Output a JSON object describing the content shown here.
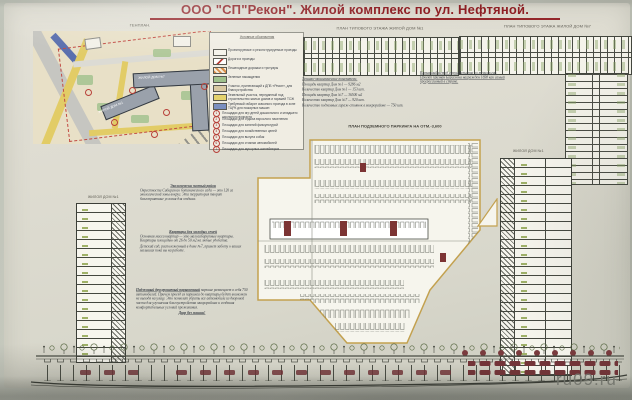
{
  "title": "ООО \"СП\"Рекон\".  Жилой комплекс по ул. Нефтяной.",
  "watermark": "ru09.ru",
  "sections": {
    "genplan": "ГЕНПЛАН.",
    "plan1": "ПЛАН ТИПОВОГО ЭТАЖА ЖИЛОЙ ДОМ №1",
    "plan7": "ПЛАН ТИПОВОГО ЭТАЖА ЖИЛОЙ ДОМ №7",
    "parking": "ПЛАН ПОДЗЕМНОГО ПАРКИНГА НА ОТМ.-3,600",
    "tower_left": "ЖИЛОЙ ДОМ №1",
    "tower_right": "ЖИЛОЙ ДОМ №1"
  },
  "genplan": {
    "building1": "ЖИЛОЙ ДОМ №1",
    "building7": "ЖИЛОЙ ДОМ №7"
  },
  "legend": {
    "title": "Условные обозначения",
    "swatches": [
      {
        "color": "#f5f3ea",
        "label": "Проектируемые и реконструируемые проезды"
      },
      {
        "color": "#ffffff",
        "label": "Дороги и проезды"
      },
      {
        "color": "#d98f4a",
        "label": "Пешеходные дорожки и тротуары"
      },
      {
        "color": "#9fc18c",
        "label": "Зеленые насаждения"
      },
      {
        "color": "#d9c9a2",
        "label": "Участок, прилегающий к ДПБ «Рекон», для благоустройства"
      },
      {
        "color": "#e4d26b",
        "label": "Земельный участок, переданный под строительство жилых домов и гаражей ТСЖ"
      },
      {
        "color": "#7a8fc0",
        "label": "Требуемый габарит сквозного проезда в зоне ТЦРК для пожарных машин"
      }
    ],
    "numbered": [
      {
        "n": "1",
        "label": "Площадки для игр детей дошкольного и младшего школьного возраста"
      },
      {
        "n": "2",
        "label": "Площадки для отдыха взрослого населения"
      },
      {
        "n": "3",
        "label": "Площадки для занятий физкультурой"
      },
      {
        "n": "4",
        "label": "Площадки для хозяйственных целей"
      },
      {
        "n": "5",
        "label": "Площадки для выгула собак"
      },
      {
        "n": "6",
        "label": "Площадки для стоянки автомобилей"
      },
      {
        "n": "7",
        "label": "Площадки для мусорных контейнеров"
      }
    ]
  },
  "tep": {
    "title": "Технико-экономические показатели:",
    "lines": [
      "Площадь квартир  Дом №1 — 9286 м2",
      "Количество квартир  Дом №1 — 153 шт.",
      "Площадь квартир  Дом №7 — 36500 м2",
      "Количество квартир  Дом №7 — 920 шт.",
      "Количество подземных гараж-стоянок в микрорайоне — 750 шт."
    ]
  },
  "note_right": "Каркасный метод строительства по технологии. Проект признан Барселона награжден 1698 как самый прогрессивный в стране.",
  "notes": {
    "eco": {
      "head": "Экологически чистый район",
      "body": "Окрестности Сибирского ботанического сада — это 120 га экологической зоны вокруг. Эта территория творит благоприятные условия для отдыха."
    },
    "flats": {
      "head": "Квартиры для молодых семей",
      "body": "Основная масса квартир — это малогабаритные квартиры. Квартиры площадью от 26 до 50 м2 на любые удобства.",
      "body2": "Детский сад, расположенный в доме №7, примет заботу о ваших малышах пока вы на работе."
    },
    "parking": {
      "head": "Подземный двухуровневый парковочный",
      "body": "паркинг размещает в себя 750 автомобилей. Причем проезд из паркинга до квартиры будет возможен не выходя на улицу. Это позволит убрать все автомобили из дворовой части для улучшения благоустройства микрорайона и создания комфортабельных условий проживания.",
      "slogan": "Двор без машин!"
    }
  },
  "colors": {
    "title_red": "#8e1f24",
    "parking_outline": "#c3a14f",
    "map_yellow": "#e2cc66",
    "map_green": "#aec798",
    "map_blue": "#5a6fae",
    "building_gray": "#9aa1ab",
    "car_maroon": "#733438",
    "ink": "#3c4148"
  }
}
